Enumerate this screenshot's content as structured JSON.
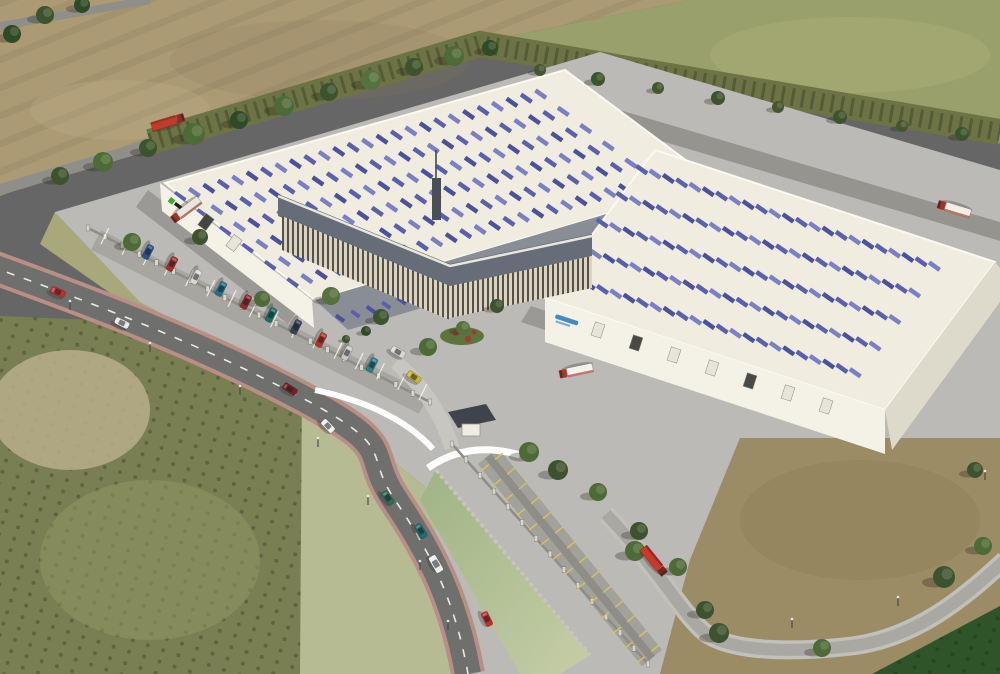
{
  "meta": {
    "subject": "Aerial 3D architectural rendering of a logistics park: two large cream warehouses with rows of blue solar panels on the roofs, an angled central office building with louvered facade, perimeter fence with gated entrance, access roads with cars and red-cab trucks, surrounded by plowed fields, olive groves and dirt land"
  },
  "palette": {
    "plowed_field": "#ab9a74",
    "olive_field": "#9aa06b",
    "shrub_band": "#6d7345",
    "grove": "#7a7f53",
    "sand_patch": "#b7ae8b",
    "grass_out": "#a9a87b",
    "grass_mid": "#b7bb93",
    "dirt": "#9b8c66",
    "hedge": "#2f5429",
    "yard": "#bcbab6",
    "road_top": "#8f8e89",
    "asphalt": "#6f6f6d",
    "sidewalk": "#b98e85",
    "br_road": "#aaa8a3",
    "br_walk": "#c2c0bb",
    "rear_road": "#95948f",
    "canal_a": "#9fb486",
    "canal_b": "#c6cda6",
    "roof_cream": "#f0ecdf",
    "roof_edge": "#fbf9f2",
    "wall_white": "#f4f1e7",
    "wall_shade": "#ddd9cb",
    "roof_dark_band": "#898d96",
    "office_roof": "#666c78",
    "tower": "#4a4e57",
    "gate_roof": "#3f434b",
    "driveway": "#c8c6c1",
    "strip_pave": "#a3a19c",
    "sw_strip": "#a8a6a1",
    "stall_yellow": "#d9c25a",
    "panel_a": "#5a5fae",
    "panel_b": "#7b7fc6",
    "panel_c": "#4c519e",
    "logo_left_mark": "#3aaa35",
    "logo_left_text": "#1e1e1e",
    "logo_right": "#2f7fc0",
    "flower_red": "#a43b2e",
    "flower_bed": "#5c7440"
  },
  "buildings": {
    "left_warehouse": {
      "panel_bands": 6,
      "logo": "small green mark with dark wordmark (illegible)"
    },
    "right_warehouse": {
      "panel_bands": 5,
      "logo": "blue wordmark on front wall (illegible)"
    },
    "office": {
      "facade": "vertical louver stripes",
      "roof": "dark grey band with mast"
    }
  },
  "scene": {
    "roofs": [
      {
        "layer": "solar-panels-left",
        "x": 165,
        "y": 185,
        "ux": 0.962,
        "uy": -0.273,
        "vx": 150,
        "vy": 115,
        "bands": [
          0.1,
          0.25,
          0.4,
          0.55,
          0.7,
          0.85
        ],
        "count": 26,
        "step": 15,
        "sw": 4.5,
        "sh": 13,
        "tilt": -55,
        "colors": [
          "#5a5fae",
          "#7b7fc6",
          "#4c519e"
        ]
      },
      {
        "layer": "solar-panels-band",
        "x": 332,
        "y": 312,
        "ux": 0.962,
        "uy": -0.273,
        "vx": 18,
        "vy": 14,
        "bands": [
          0.45
        ],
        "count": 23,
        "step": 16,
        "sw": 4,
        "sh": 10,
        "tilt": -55,
        "colors": [
          "#4c519e",
          "#5a5fae"
        ]
      },
      {
        "layer": "solar-panels-right",
        "x": 655,
        "y": 152,
        "ux": 0.95,
        "uy": 0.313,
        "vx": -110,
        "vy": 148,
        "bands": [
          0.12,
          0.3,
          0.48,
          0.66,
          0.84
        ],
        "count": 23,
        "step": 14,
        "sw": 4.5,
        "sh": 13,
        "tilt": -55,
        "colors": [
          "#5a5fae",
          "#7b7fc6",
          "#4c519e"
        ]
      }
    ],
    "fences": [
      {
        "x1": 88,
        "y1": 228,
        "x2": 430,
        "y2": 402,
        "n": 20
      },
      {
        "x1": 452,
        "y1": 444,
        "x2": 648,
        "y2": 664,
        "n": 14
      }
    ],
    "ticks": [
      {
        "x1": 100,
        "y1": 246,
        "x2": 418,
        "y2": 402,
        "n": 15,
        "o1": -20,
        "o2": -2,
        "color": "rgba(255,255,255,0.75)",
        "w": 1.2
      },
      {
        "x1": 492,
        "y1": 462,
        "x2": 648,
        "y2": 654,
        "n": 13,
        "o1": 4,
        "o2": 14,
        "color": "#d9c25a",
        "w": 1.4
      },
      {
        "x1": 492,
        "y1": 462,
        "x2": 648,
        "y2": 654,
        "n": 13,
        "o1": -4,
        "o2": -14,
        "color": "#d9c25a",
        "w": 1.4
      }
    ],
    "doors": [
      {
        "x": 598,
        "y": 330,
        "rot": 18,
        "fill": "#e7e4da"
      },
      {
        "x": 636,
        "y": 343,
        "rot": 18,
        "fill": "#474a45"
      },
      {
        "x": 674,
        "y": 355,
        "rot": 18,
        "fill": "#e7e4da"
      },
      {
        "x": 712,
        "y": 368,
        "rot": 18,
        "fill": "#e7e4da"
      },
      {
        "x": 750,
        "y": 381,
        "rot": 18,
        "fill": "#474a45"
      },
      {
        "x": 788,
        "y": 393,
        "rot": 18,
        "fill": "#e7e4da"
      },
      {
        "x": 826,
        "y": 406,
        "rot": 18,
        "fill": "#e7e4da"
      },
      {
        "x": 206,
        "y": 222,
        "rot": 37,
        "fill": "#44463f"
      },
      {
        "x": 234,
        "y": 243,
        "rot": 37,
        "fill": "#e7e4da"
      }
    ],
    "trees": [
      {
        "x": 60,
        "y": 176,
        "r": 9,
        "c": "#3d5330"
      },
      {
        "x": 103,
        "y": 162,
        "r": 10,
        "c": "#4c6b36"
      },
      {
        "x": 148,
        "y": 148,
        "r": 9,
        "c": "#3d5330"
      },
      {
        "x": 194,
        "y": 134,
        "r": 11,
        "c": "#4c6b36"
      },
      {
        "x": 239,
        "y": 120,
        "r": 9,
        "c": "#2f4a26"
      },
      {
        "x": 284,
        "y": 106,
        "r": 10,
        "c": "#4c6b36"
      },
      {
        "x": 329,
        "y": 92,
        "r": 9,
        "c": "#3d5330"
      },
      {
        "x": 371,
        "y": 80,
        "r": 10,
        "c": "#55713d"
      },
      {
        "x": 414,
        "y": 67,
        "r": 9,
        "c": "#3d5330"
      },
      {
        "x": 454,
        "y": 56,
        "r": 10,
        "c": "#4c6b36"
      },
      {
        "x": 490,
        "y": 48,
        "r": 8,
        "c": "#2f4a26"
      },
      {
        "x": 540,
        "y": 70,
        "r": 6,
        "c": "#46552f"
      },
      {
        "x": 598,
        "y": 79,
        "r": 7,
        "c": "#3d5330"
      },
      {
        "x": 658,
        "y": 88,
        "r": 6,
        "c": "#46552f"
      },
      {
        "x": 718,
        "y": 98,
        "r": 7,
        "c": "#3d5330"
      },
      {
        "x": 778,
        "y": 107,
        "r": 6,
        "c": "#46552f"
      },
      {
        "x": 840,
        "y": 117,
        "r": 7,
        "c": "#3d5330"
      },
      {
        "x": 902,
        "y": 126,
        "r": 6,
        "c": "#46552f"
      },
      {
        "x": 962,
        "y": 134,
        "r": 7,
        "c": "#3d5330"
      },
      {
        "x": 12,
        "y": 34,
        "r": 9,
        "c": "#2f4a26"
      },
      {
        "x": 45,
        "y": 15,
        "r": 9,
        "c": "#3d5330"
      },
      {
        "x": 82,
        "y": 5,
        "r": 8,
        "c": "#2f4a26"
      },
      {
        "x": 132,
        "y": 242,
        "r": 9,
        "c": "#4c6b36"
      },
      {
        "x": 200,
        "y": 237,
        "r": 8,
        "c": "#3d5330"
      },
      {
        "x": 262,
        "y": 299,
        "r": 8,
        "c": "#4c6b36"
      },
      {
        "x": 331,
        "y": 296,
        "r": 9,
        "c": "#55713d"
      },
      {
        "x": 381,
        "y": 317,
        "r": 8,
        "c": "#3d5330"
      },
      {
        "x": 428,
        "y": 347,
        "r": 9,
        "c": "#4c6b36"
      },
      {
        "x": 463,
        "y": 328,
        "r": 7,
        "c": "#55713d"
      },
      {
        "x": 497,
        "y": 306,
        "r": 7,
        "c": "#3d5330"
      },
      {
        "x": 366,
        "y": 331,
        "r": 5,
        "c": "#2f4a26"
      },
      {
        "x": 346,
        "y": 339,
        "r": 4,
        "c": "#3d5330"
      },
      {
        "x": 529,
        "y": 452,
        "r": 10,
        "c": "#4c6b36"
      },
      {
        "x": 558,
        "y": 470,
        "r": 10,
        "c": "#3d5330"
      },
      {
        "x": 598,
        "y": 492,
        "r": 9,
        "c": "#4c6b36"
      },
      {
        "x": 639,
        "y": 531,
        "r": 9,
        "c": "#3d5330"
      },
      {
        "x": 678,
        "y": 567,
        "r": 9,
        "c": "#4c6b36"
      },
      {
        "x": 705,
        "y": 610,
        "r": 9,
        "c": "#3d5330"
      },
      {
        "x": 635,
        "y": 551,
        "r": 10,
        "c": "#4c6b36"
      },
      {
        "x": 719,
        "y": 633,
        "r": 10,
        "c": "#3d5330"
      },
      {
        "x": 822,
        "y": 648,
        "r": 9,
        "c": "#4c6b36"
      },
      {
        "x": 944,
        "y": 577,
        "r": 11,
        "c": "#3d5330"
      },
      {
        "x": 983,
        "y": 546,
        "r": 9,
        "c": "#4c6b36"
      },
      {
        "x": 975,
        "y": 470,
        "r": 8,
        "c": "#3d5330"
      }
    ],
    "poles": [
      {
        "x": 70,
        "y": 310
      },
      {
        "x": 150,
        "y": 352
      },
      {
        "x": 240,
        "y": 395
      },
      {
        "x": 318,
        "y": 447
      },
      {
        "x": 368,
        "y": 505
      },
      {
        "x": 420,
        "y": 570
      },
      {
        "x": 448,
        "y": 630
      },
      {
        "x": 792,
        "y": 628
      },
      {
        "x": 898,
        "y": 606
      },
      {
        "x": 985,
        "y": 480
      }
    ],
    "vehicles": [
      {
        "type": "truck",
        "name": "truck-field-road",
        "x": 168,
        "y": 122,
        "rot": -17,
        "cab": "#8f2b20",
        "box": "#c23a2a"
      },
      {
        "type": "truck",
        "name": "truck-left-dock",
        "x": 186,
        "y": 210,
        "rot": 143,
        "cab": "#a53125",
        "box": "#e9e6df"
      },
      {
        "type": "truck",
        "name": "truck-right-dock",
        "x": 576,
        "y": 371,
        "rot": 168,
        "cab": "#b03226",
        "box": "#f4f2ec"
      },
      {
        "type": "truck",
        "name": "truck-rear-road",
        "x": 954,
        "y": 209,
        "rot": 197,
        "cab": "#a53125",
        "box": "#f2efe8"
      },
      {
        "type": "truck",
        "name": "truck-southeast-road",
        "x": 654,
        "y": 561,
        "rot": 51,
        "cab": "#7e241b",
        "box": "#cc3826"
      },
      {
        "type": "car",
        "name": "car-road-1",
        "x": 58,
        "y": 292,
        "rot": 24,
        "color": "#c03028"
      },
      {
        "type": "car",
        "name": "car-road-2",
        "x": 122,
        "y": 323,
        "rot": 27,
        "color": "#e8e8e8"
      },
      {
        "type": "car",
        "name": "car-road-3",
        "x": 290,
        "y": 389,
        "rot": 32,
        "color": "#7a1f26"
      },
      {
        "type": "car",
        "name": "car-road-4",
        "x": 328,
        "y": 426,
        "rot": 46,
        "color": "#f0f0ef"
      },
      {
        "type": "car",
        "name": "car-road-5",
        "x": 388,
        "y": 498,
        "rot": 55,
        "color": "#2e6e55"
      },
      {
        "type": "car",
        "name": "car-road-6",
        "x": 421,
        "y": 531,
        "rot": 57,
        "color": "#1d6f74"
      },
      {
        "type": "van",
        "name": "van-road",
        "x": 436,
        "y": 564,
        "rot": 60,
        "color": "#efefec"
      },
      {
        "type": "car",
        "name": "car-road-7",
        "x": 487,
        "y": 619,
        "rot": 64,
        "color": "#c03028"
      },
      {
        "type": "car",
        "name": "parked-car-1",
        "x": 148,
        "y": 252,
        "rot": 117,
        "color": "#2b4f8e"
      },
      {
        "type": "car",
        "name": "parked-car-2",
        "x": 172,
        "y": 264,
        "rot": 117,
        "color": "#a72c22"
      },
      {
        "type": "car",
        "name": "parked-car-3",
        "x": 196,
        "y": 277,
        "rot": 117,
        "color": "#d8d8d4"
      },
      {
        "type": "car",
        "name": "parked-car-4",
        "x": 221,
        "y": 289,
        "rot": 117,
        "color": "#1f6f8e"
      },
      {
        "type": "car",
        "name": "parked-car-5",
        "x": 246,
        "y": 302,
        "rot": 117,
        "color": "#8e2b2b"
      },
      {
        "type": "car",
        "name": "parked-car-6",
        "x": 271,
        "y": 315,
        "rot": 117,
        "color": "#1b6e62"
      },
      {
        "type": "car",
        "name": "parked-car-7",
        "x": 296,
        "y": 327,
        "rot": 117,
        "color": "#33425e"
      },
      {
        "type": "car",
        "name": "parked-car-8",
        "x": 321,
        "y": 340,
        "rot": 117,
        "color": "#b53226"
      },
      {
        "type": "car",
        "name": "parked-car-9",
        "x": 347,
        "y": 353,
        "rot": 117,
        "color": "#c9c9c4"
      },
      {
        "type": "car",
        "name": "parked-car-10",
        "x": 372,
        "y": 365,
        "rot": 117,
        "color": "#27808a"
      },
      {
        "type": "car",
        "name": "car-lot-1",
        "x": 398,
        "y": 352,
        "rot": 30,
        "color": "#d8d8d4"
      },
      {
        "type": "car",
        "name": "car-yellow",
        "x": 414,
        "y": 377,
        "rot": 35,
        "color": "#c7b52e"
      }
    ]
  }
}
